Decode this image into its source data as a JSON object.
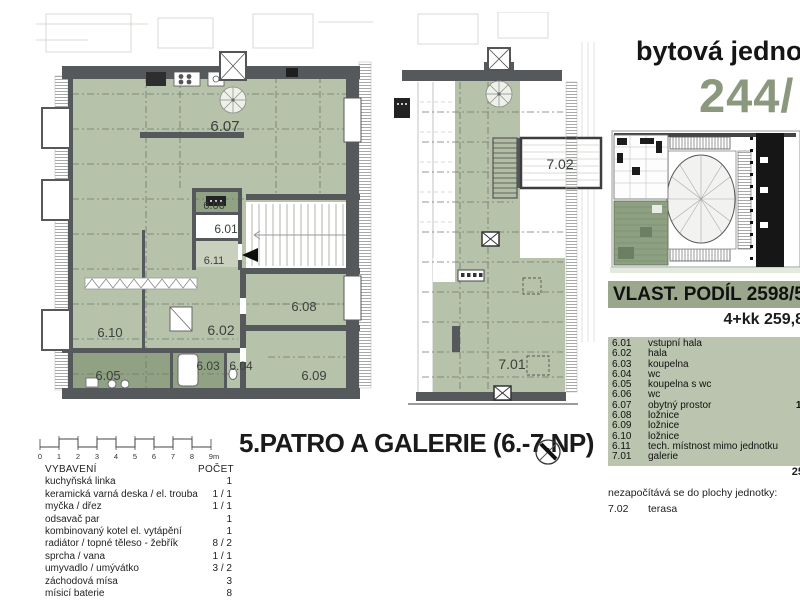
{
  "header": {
    "title": "bytová jednotk",
    "unit_number": "244/"
  },
  "ownership": {
    "share_label": "VLAST. PODÍL 2598/585",
    "disposition": "4+kk 259,8"
  },
  "room_table": {
    "rows": [
      {
        "id": "6.01",
        "name": "vstupní hala",
        "area": ""
      },
      {
        "id": "6.02",
        "name": "hala",
        "area": ""
      },
      {
        "id": "6.03",
        "name": "koupelna",
        "area": ""
      },
      {
        "id": "6.04",
        "name": "wc",
        "area": ""
      },
      {
        "id": "6.05",
        "name": "koupelna s wc",
        "area": ""
      },
      {
        "id": "6.06",
        "name": "wc",
        "area": ""
      },
      {
        "id": "6.07",
        "name": "obytný prostor",
        "area": "10"
      },
      {
        "id": "6.08",
        "name": "ložnice",
        "area": "1"
      },
      {
        "id": "6.09",
        "name": "ložnice",
        "area": "1"
      },
      {
        "id": "6.10",
        "name": "ložnice",
        "area": "2"
      },
      {
        "id": "6.11",
        "name": "tech. místnost mimo jednotku",
        "area": ""
      },
      {
        "id": "7.01",
        "name": "galerie",
        "area": "7"
      }
    ],
    "total": "25",
    "excluded_note": "nezapočítává se do plochy jednotky:",
    "excluded": [
      {
        "id": "7.02",
        "name": "terasa",
        "area": ""
      }
    ]
  },
  "plan": {
    "title": "5.PATRO A GALERIE (6.-7.NP)",
    "scale_labels": [
      "0",
      "1",
      "2",
      "3",
      "4",
      "5",
      "6",
      "7",
      "8",
      "9m"
    ]
  },
  "equipment": {
    "title": "VYBAVENÍ",
    "count_header": "POČET",
    "items": [
      {
        "name": "kuchyňská linka",
        "count": "1"
      },
      {
        "name": "keramická varná deska / el. trouba",
        "count": "1 / 1"
      },
      {
        "name": "myčka / dřez",
        "count": "1 / 1"
      },
      {
        "name": "odsavač par",
        "count": "1"
      },
      {
        "name": "kombinovaný kotel el. vytápění",
        "count": "1"
      },
      {
        "name": "radiátor / topné těleso - žebřík",
        "count": "8 / 2"
      },
      {
        "name": "sprcha / vana",
        "count": "1 / 1"
      },
      {
        "name": "umyvadlo / umývátko",
        "count": "3 / 2"
      },
      {
        "name": "záchodová mísa",
        "count": "3"
      },
      {
        "name": "mísicí baterie",
        "count": "8"
      }
    ]
  },
  "colors": {
    "floor_green": "#b7c2ab",
    "wet_room_green": "#91a183",
    "wall_gray": "#56595c",
    "accent_green": "#8c987e",
    "bar_green": "#9aa78c"
  }
}
